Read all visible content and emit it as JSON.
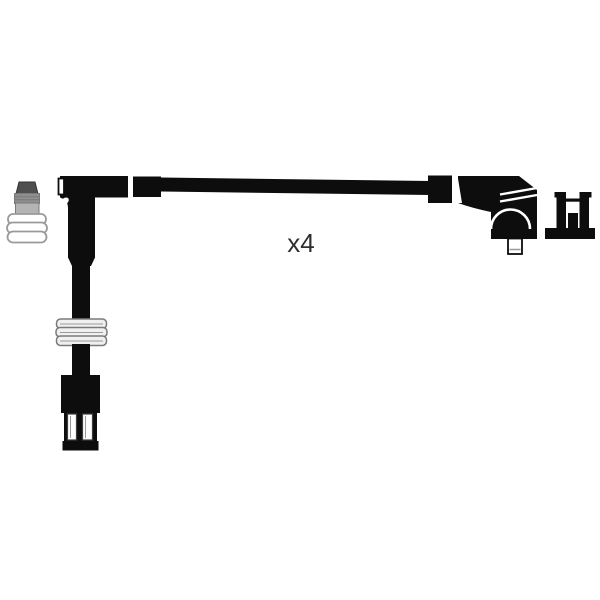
{
  "label": {
    "quantity": "x4"
  },
  "parts": {
    "left_icon": "spark-plug-terminal-icon",
    "right_icon": "coil-terminal-bracket-icon",
    "cable": "ignition-lead-cable",
    "left_boot": "angled-spark-plug-boot",
    "right_boot": "angled-coil-boot",
    "bottom_connector": "cable-end-connector"
  },
  "colors": {
    "background": "#ffffff",
    "ink": "#0d0d0d",
    "paper": "#ffffff",
    "gray_dark": "#4f4f4f",
    "gray_darker": "#333333",
    "gray_ridge": "#8f8f8f",
    "gray_block": "#b4b4b4",
    "gray_mid": "#9a9a9a",
    "gray_outline": "#7a7a7a",
    "gray_light": "#f0f0f0",
    "slot_stroke": "#3c3c3c",
    "text_color": "#2e2e2e"
  }
}
